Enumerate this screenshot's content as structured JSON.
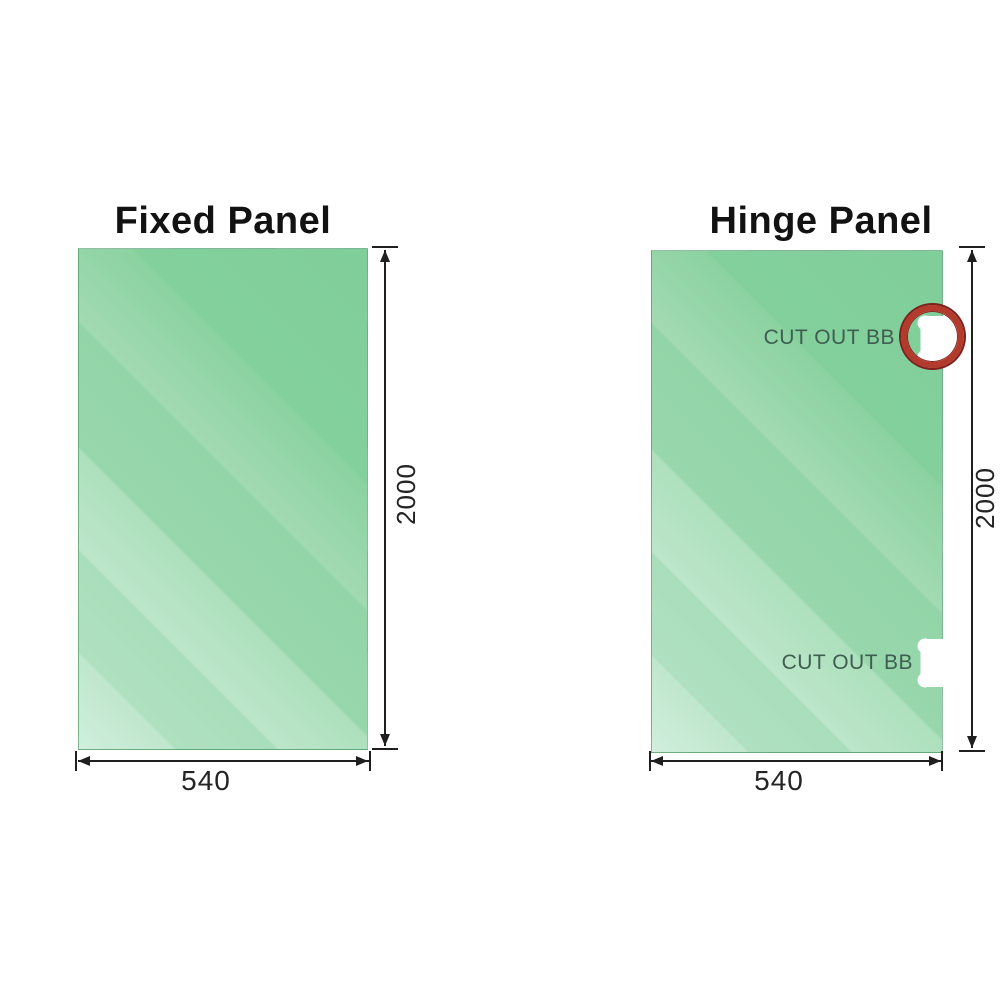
{
  "image_type": "glass shower screen panel dimension diagram",
  "colors": {
    "background": "#ffffff",
    "glass_dark": "#80ce9a",
    "glass_light": "#d0efdc",
    "dimension_line": "#1f1f1f",
    "cutout_label_text": "#3e5e50",
    "highlight_ring_red": "#b23b2d",
    "highlight_ring_dark_red": "#7d211c"
  },
  "diagrams": [
    {
      "id": "fixed-panel",
      "title": "Fixed Panel",
      "width_label": "540",
      "height_label": "2000",
      "cutouts": []
    },
    {
      "id": "hinge-panel",
      "title": "Hinge Panel",
      "width_label": "540",
      "height_label": "2000",
      "cutouts": [
        {
          "label": "CUT OUT BB",
          "position": "top-right",
          "highlighted_with_red_circle": true
        },
        {
          "label": "CUT OUT BB",
          "position": "bottom-right",
          "highlighted_with_red_circle": false
        }
      ]
    }
  ]
}
